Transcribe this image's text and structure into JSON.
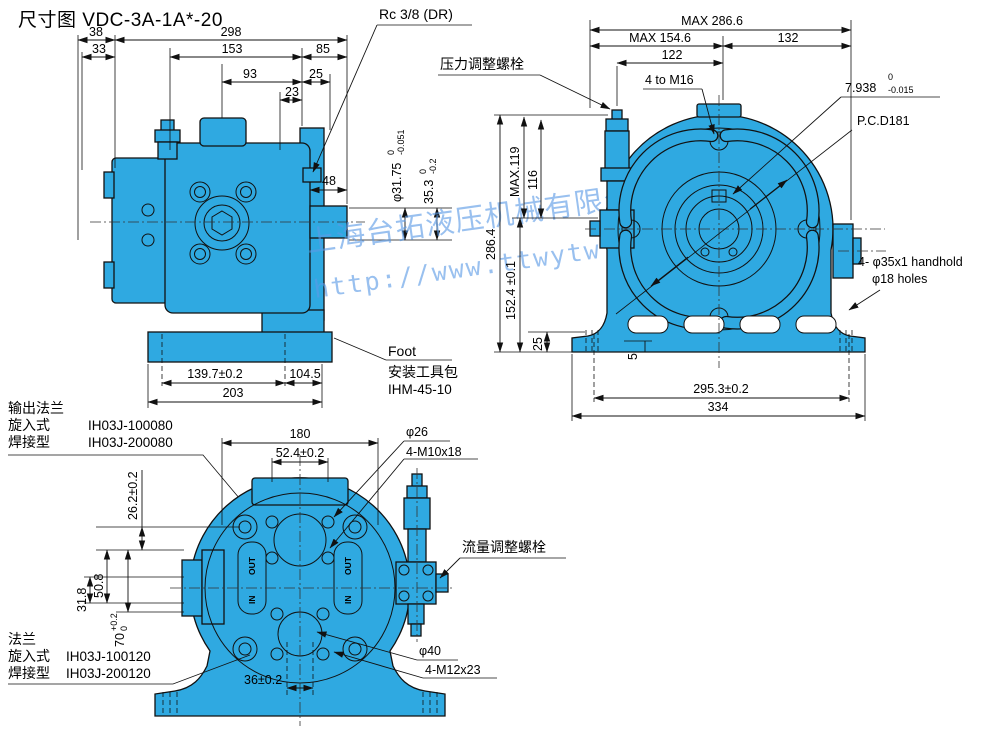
{
  "title": "尺寸图 VDC-3A-1A*-20",
  "watermark": {
    "company": "上海台拓液压机械有限公司",
    "url": "http://www.ttwytw.com"
  },
  "colors": {
    "pump_blue": "#2FA9E1",
    "line_black": "#111111",
    "watermark_blue": "#5B9BE6"
  },
  "side_view": {
    "dims": {
      "d38": "38",
      "d33": "33",
      "d298": "298",
      "d153": "153",
      "d85": "85",
      "d93": "93",
      "d25": "25",
      "d23": "23",
      "d48": "48",
      "d1397": "139.7±0.2",
      "d1045": "104.5",
      "d203": "203"
    },
    "shaft_dia": {
      "value": "φ31.75",
      "tol_top": "0",
      "tol_bot": "-0.051"
    },
    "pilot": {
      "value": "35.3",
      "tol_top": "0",
      "tol_bot": "-0.2"
    },
    "drain_label": "Rc 3/8 (DR)",
    "foot_label": "Foot",
    "kit_label_1": "安装工具包",
    "kit_label_2": "IHM-45-10",
    "flange_title": "输出法兰",
    "flange_rows": [
      {
        "type": "旋入式",
        "pn": "IH03J-100080"
      },
      {
        "type": "焊接型",
        "pn": "IH03J-200080"
      }
    ]
  },
  "front_view": {
    "dims": {
      "max_w": "MAX 286.6",
      "max_w2": "MAX 154.6",
      "d132": "132",
      "d122": "122",
      "d2864": "286.4",
      "max119": "MAX.119",
      "d116": "116",
      "d1524": "152.4 ±0.1",
      "d25": "25",
      "d5": "5",
      "d2953": "295.3±0.2",
      "d334": "334"
    },
    "bolts_label": "4 to M16",
    "key": {
      "value": "7.938",
      "tol_top": "0",
      "tol_bot": "-0.015"
    },
    "pcd_label": "P.C.D181",
    "pressure_label": "压力调整螺栓",
    "handhold_label_1": "4- φ35x1 handhold",
    "handhold_label_2": "φ18 holes"
  },
  "bottom_view": {
    "dims": {
      "d180": "180",
      "d524": "52.4±0.2",
      "d262": "26.2±0.2",
      "d508": "50.8",
      "d318": "31.8",
      "d36": "36±0.2"
    },
    "d70": {
      "value": "70",
      "tol_top": "+0.2",
      "tol_bot": "0"
    },
    "port_dia_label": "φ26",
    "bolts_top_label": "4-M10x18",
    "port_dia2_label": "φ40",
    "bolts_bottom_label": "4-M12x23",
    "flow_label": "流量调整螺栓",
    "flange_title": "法兰",
    "flange_rows": [
      {
        "type": "旋入式",
        "pn": "IH03J-100120"
      },
      {
        "type": "焊接型",
        "pn": "IH03J-200120"
      }
    ],
    "ports": {
      "out": "OUT",
      "in": "IN"
    }
  }
}
